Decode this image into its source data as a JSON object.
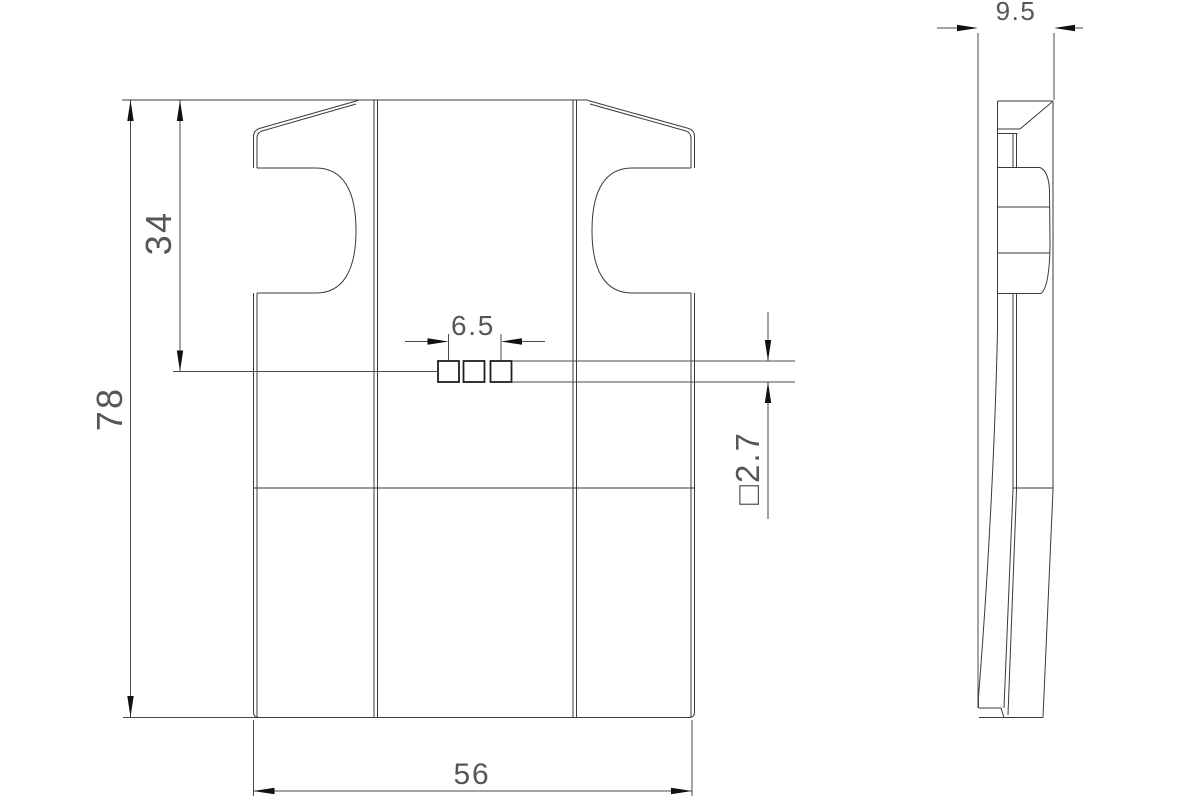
{
  "drawing": {
    "type": "engineering-drawing-two-views",
    "background": "#ffffff",
    "line_color": "#3a3a3a",
    "arrow_color": "#111111",
    "text_color": "#565656",
    "views": {
      "front": {
        "name": "front-view",
        "features": [
          "side-notches",
          "two-bend-lines",
          "three-square-slots",
          "mid-feature-line"
        ]
      },
      "side": {
        "name": "side-view",
        "features": [
          "top-chamfer",
          "raised-tab",
          "bowed-face",
          "bottom-taper"
        ]
      }
    },
    "dimensions": {
      "overall_height": {
        "label": "78"
      },
      "upper_section_height": {
        "label": "34"
      },
      "overall_width": {
        "label": "56"
      },
      "slot_spacing": {
        "label": "6.5"
      },
      "slot_size": {
        "label": "□2.7"
      },
      "overall_depth": {
        "label": "9.5"
      }
    }
  }
}
